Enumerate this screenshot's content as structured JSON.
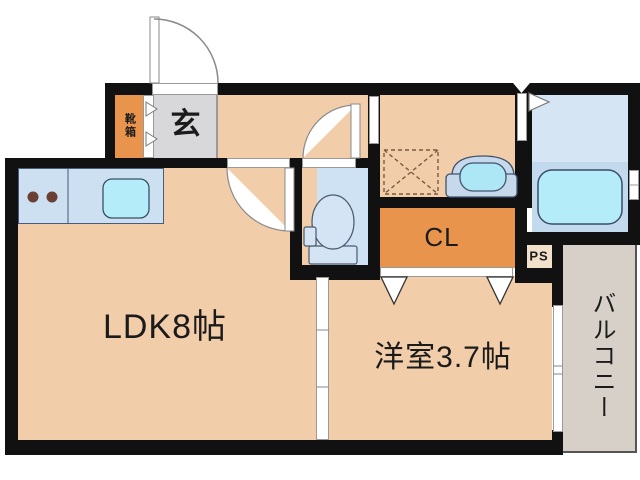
{
  "plan": {
    "title": "1K floor plan",
    "labels": {
      "shoe_box": "靴箱",
      "entrance": "玄",
      "ldk": "LDK8帖",
      "western_room": "洋室3.7帖",
      "closet": "CL",
      "pipe_space": "PS",
      "balcony": "バルコニー"
    },
    "colors": {
      "room_floor_peach": "#f2cda9",
      "accent_orange": "#e8944d",
      "entrance_tile_gray": "#d8d8da",
      "wet_area_blue": "#cfe2f3",
      "bathroom_upper_blue": "#d6e5f3",
      "bathroom_lower_blue": "#c3d9ed",
      "fixture_cyan": "#b5ecf9",
      "kitchen_counter_blue": "#cce0f2",
      "balcony_gray": "#d6d0c9",
      "pipe_space_tan": "#f1e1ca",
      "burner_brown": "#6b4034",
      "wall_black": "#111111"
    }
  }
}
